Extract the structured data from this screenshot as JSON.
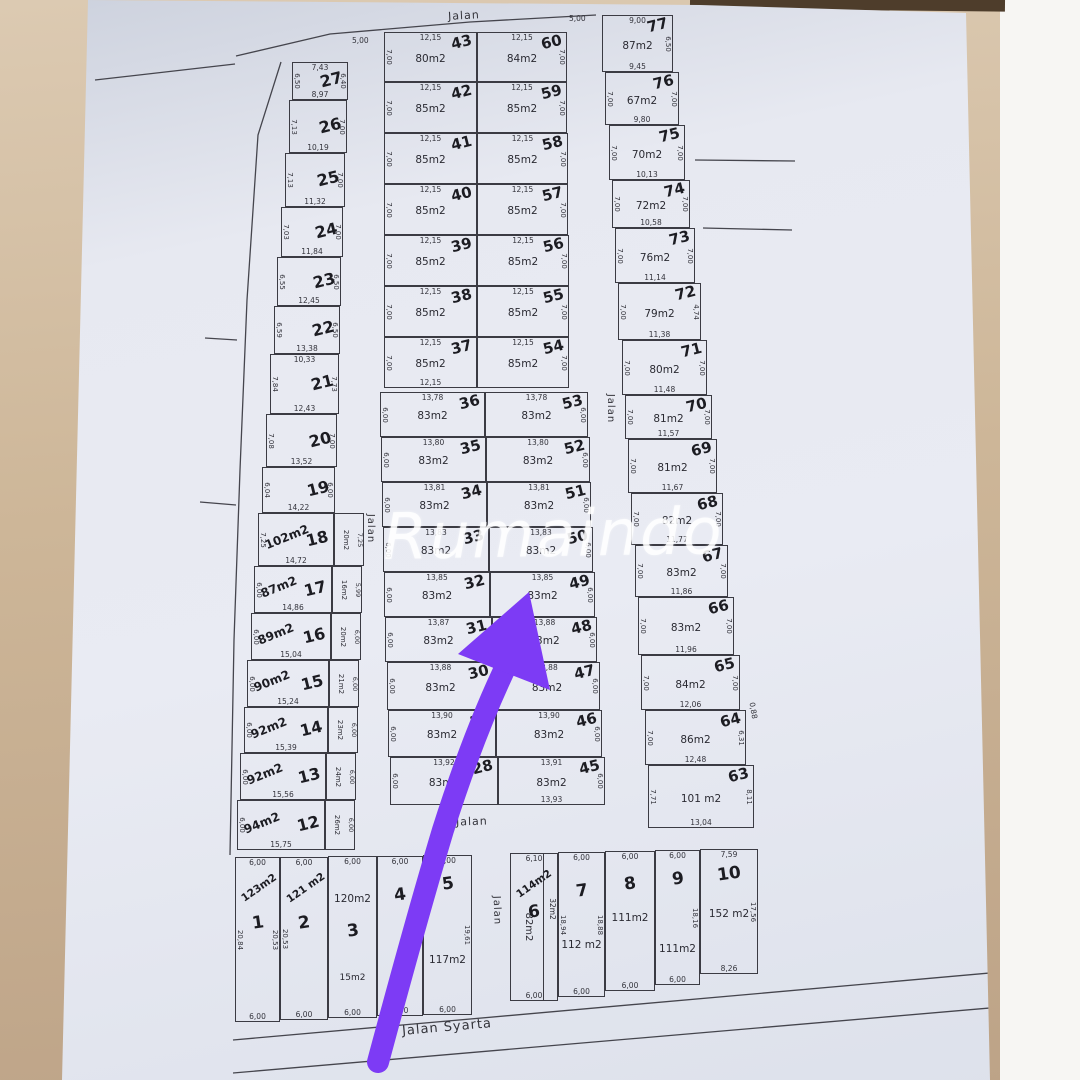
{
  "watermark": "Rumaindo",
  "arrow_color": "#7d3bf5",
  "road_labels": [
    {
      "text": "Jalan",
      "x": 448,
      "y": 9,
      "rot": -3,
      "fs": 11
    },
    {
      "text": "Jalan",
      "x": 356,
      "y": 523,
      "rot": 90,
      "fs": 10
    },
    {
      "text": "Jalan",
      "x": 596,
      "y": 403,
      "rot": 90,
      "fs": 10
    },
    {
      "text": "Jalan",
      "x": 456,
      "y": 815,
      "rot": -2,
      "fs": 11
    },
    {
      "text": "Jalan",
      "x": 482,
      "y": 905,
      "rot": 88,
      "fs": 10
    },
    {
      "text": "Jalan Syarta",
      "x": 402,
      "y": 1020,
      "rot": -5,
      "fs": 13
    }
  ],
  "extra_dims": [
    {
      "text": "5,00",
      "x": 569,
      "y": 14,
      "rot": 0
    },
    {
      "text": "5,00",
      "x": 352,
      "y": 36,
      "rot": 0
    },
    {
      "text": "0,88",
      "x": 745,
      "y": 706,
      "rot": 80
    }
  ],
  "columns": {
    "left": {
      "plots": [
        {
          "num": "27",
          "dimT": "7,43",
          "dimB": "8,97",
          "dimL": "6,50",
          "dimR": "6,40",
          "x": 292,
          "y": 62,
          "w": 56,
          "h": 38
        },
        {
          "num": "26",
          "dimB": "10,19",
          "dimL": "7,13",
          "dimR": "7,00",
          "x": 289,
          "y": 100,
          "w": 58,
          "h": 53
        },
        {
          "num": "25",
          "dimB": "11,32",
          "dimL": "7,13",
          "dimR": "7,00",
          "x": 285,
          "y": 153,
          "w": 60,
          "h": 54
        },
        {
          "num": "24",
          "dimB": "11,84",
          "dimL": "7,03",
          "dimR": "7,00",
          "x": 281,
          "y": 207,
          "w": 62,
          "h": 50
        },
        {
          "num": "23",
          "dimB": "12,45",
          "dimL": "6,55",
          "dimR": "6,50",
          "x": 277,
          "y": 257,
          "w": 64,
          "h": 49
        },
        {
          "num": "22",
          "dimB": "13,38",
          "dimL": "6,59",
          "dimR": "6,50",
          "x": 274,
          "y": 306,
          "w": 66,
          "h": 48
        },
        {
          "num": "21",
          "dimT": "10,33",
          "dimB": "12,43",
          "dimL": "7,84",
          "dimR": "7,73",
          "x": 270,
          "y": 354,
          "w": 69,
          "h": 60
        },
        {
          "num": "20",
          "dimB": "13,52",
          "dimL": "7,08",
          "dimR": "7,00",
          "x": 266,
          "y": 414,
          "w": 71,
          "h": 53
        },
        {
          "num": "19",
          "dimB": "14,22",
          "dimL": "6,04",
          "dimR": "6,00",
          "x": 262,
          "y": 467,
          "w": 73,
          "h": 46
        },
        {
          "num": "18",
          "hand": "102m2",
          "dimB": "14,72",
          "dimL": "7,25",
          "strip": {
            "area": "20m2",
            "dim": "7,25"
          },
          "x": 258,
          "y": 513,
          "w": 76,
          "h": 53
        },
        {
          "num": "17",
          "hand": "87m2",
          "dimB": "14,86",
          "dimL": "6,00",
          "strip": {
            "area": "16m2",
            "dim": "5,99"
          },
          "x": 254,
          "y": 566,
          "w": 78,
          "h": 47
        },
        {
          "num": "16",
          "hand": "89m2",
          "dimB": "15,04",
          "dimL": "6,00",
          "strip": {
            "area": "20m2",
            "dim": "6,00"
          },
          "x": 251,
          "y": 613,
          "w": 80,
          "h": 47
        },
        {
          "num": "15",
          "hand": "90m2",
          "dimB": "15,24",
          "dimL": "6,00",
          "strip": {
            "area": "21m2",
            "dim": "6,00"
          },
          "x": 247,
          "y": 660,
          "w": 82,
          "h": 47
        },
        {
          "num": "14",
          "hand": "92m2",
          "dimB": "15,39",
          "dimL": "6,00",
          "strip": {
            "area": "23m2",
            "dim": "6,00"
          },
          "x": 244,
          "y": 707,
          "w": 84,
          "h": 46
        },
        {
          "num": "13",
          "hand": "92m2",
          "dimB": "15,56",
          "dimL": "6,00",
          "strip": {
            "area": "24m2",
            "dim": "6,00"
          },
          "x": 240,
          "y": 753,
          "w": 86,
          "h": 47
        },
        {
          "num": "12",
          "hand": "94m2",
          "dimB": "15,75",
          "dimL": "6,00",
          "strip": {
            "area": "26m2",
            "dim": "6,00"
          },
          "x": 237,
          "y": 800,
          "w": 88,
          "h": 50
        }
      ]
    },
    "midLeft": {
      "plots": [
        {
          "num": "43",
          "area": "80m2",
          "dimT": "12,15",
          "dimL": "7,00",
          "x": 384,
          "y": 32,
          "w": 93,
          "h": 50
        },
        {
          "num": "42",
          "area": "85m2",
          "dimT": "12,15",
          "dimL": "7,00",
          "x": 384,
          "y": 82,
          "w": 93,
          "h": 51
        },
        {
          "num": "41",
          "area": "85m2",
          "dimT": "12,15",
          "dimL": "7,00",
          "x": 384,
          "y": 133,
          "w": 93,
          "h": 51
        },
        {
          "num": "40",
          "area": "85m2",
          "dimT": "12,15",
          "dimL": "7,00",
          "x": 384,
          "y": 184,
          "w": 93,
          "h": 51
        },
        {
          "num": "39",
          "area": "85m2",
          "dimT": "12,15",
          "dimL": "7,00",
          "x": 384,
          "y": 235,
          "w": 93,
          "h": 51
        },
        {
          "num": "38",
          "area": "85m2",
          "dimT": "12,15",
          "dimL": "7,00",
          "x": 384,
          "y": 286,
          "w": 93,
          "h": 51
        },
        {
          "num": "37",
          "area": "85m2",
          "dimT": "12,15",
          "dimB": "12,15",
          "dimL": "7,00",
          "x": 384,
          "y": 337,
          "w": 93,
          "h": 51
        },
        {
          "num": "36",
          "area": "83m2",
          "dimT": "13,78",
          "dimL": "6,00",
          "x": 380,
          "y": 392,
          "w": 105,
          "h": 45
        },
        {
          "num": "35",
          "area": "83m2",
          "dimT": "13,80",
          "dimL": "6,00",
          "x": 381,
          "y": 437,
          "w": 105,
          "h": 45
        },
        {
          "num": "34",
          "area": "83m2",
          "dimT": "13,81",
          "dimL": "6,00",
          "x": 382,
          "y": 482,
          "w": 105,
          "h": 45
        },
        {
          "num": "33",
          "area": "83m2",
          "dimT": "13,83",
          "dimL": "6,00",
          "x": 383,
          "y": 527,
          "w": 106,
          "h": 45
        },
        {
          "num": "32",
          "area": "83m2",
          "dimT": "13,85",
          "dimL": "6,00",
          "x": 384,
          "y": 572,
          "w": 106,
          "h": 45
        },
        {
          "num": "31",
          "area": "83m2",
          "dimT": "13,87",
          "dimL": "6,00",
          "x": 385,
          "y": 617,
          "w": 107,
          "h": 45
        },
        {
          "num": "30",
          "area": "83m2",
          "dimT": "13,88",
          "dimL": "6,00",
          "x": 387,
          "y": 662,
          "w": 107,
          "h": 48
        },
        {
          "num": "29",
          "area": "83m2",
          "dimT": "13,90",
          "dimL": "6,00",
          "x": 388,
          "y": 710,
          "w": 108,
          "h": 47
        },
        {
          "num": "28",
          "area": "83m2",
          "dimT": "13,92",
          "dimL": "6,00",
          "x": 390,
          "y": 757,
          "w": 108,
          "h": 48
        }
      ]
    },
    "midRight": {
      "plots": [
        {
          "num": "60",
          "area": "84m2",
          "dimT": "12,15",
          "dimR": "7,00",
          "x": 477,
          "y": 32,
          "w": 90,
          "h": 50
        },
        {
          "num": "59",
          "area": "85m2",
          "dimT": "12,15",
          "dimR": "7,00",
          "x": 477,
          "y": 82,
          "w": 90,
          "h": 51
        },
        {
          "num": "58",
          "area": "85m2",
          "dimT": "12,15",
          "dimR": "7,00",
          "x": 477,
          "y": 133,
          "w": 91,
          "h": 51
        },
        {
          "num": "57",
          "area": "85m2",
          "dimT": "12,15",
          "dimR": "7,00",
          "x": 477,
          "y": 184,
          "w": 91,
          "h": 51
        },
        {
          "num": "56",
          "area": "85m2",
          "dimT": "12,15",
          "dimR": "7,00",
          "x": 477,
          "y": 235,
          "w": 92,
          "h": 51
        },
        {
          "num": "55",
          "area": "85m2",
          "dimT": "12,15",
          "dimR": "7,00",
          "x": 477,
          "y": 286,
          "w": 92,
          "h": 51
        },
        {
          "num": "54",
          "area": "85m2",
          "dimT": "12,15",
          "dimR": "7,00",
          "x": 477,
          "y": 337,
          "w": 92,
          "h": 51
        },
        {
          "num": "53",
          "area": "83m2",
          "dimT": "13,78",
          "dimR": "6,00",
          "x": 485,
          "y": 392,
          "w": 103,
          "h": 45
        },
        {
          "num": "52",
          "area": "83m2",
          "dimT": "13,80",
          "dimR": "6,00",
          "x": 486,
          "y": 437,
          "w": 104,
          "h": 45
        },
        {
          "num": "51",
          "area": "83m2",
          "dimT": "13,81",
          "dimR": "6,00",
          "x": 487,
          "y": 482,
          "w": 104,
          "h": 45
        },
        {
          "num": "50",
          "area": "83m2",
          "dimT": "13,83",
          "dimR": "6,00",
          "x": 489,
          "y": 527,
          "w": 104,
          "h": 45
        },
        {
          "num": "49",
          "area": "83m2",
          "dimT": "13,85",
          "dimR": "6,00",
          "x": 490,
          "y": 572,
          "w": 105,
          "h": 45
        },
        {
          "num": "48",
          "area": "83m2",
          "dimT": "13,88",
          "dimR": "6,00",
          "x": 492,
          "y": 617,
          "w": 105,
          "h": 45
        },
        {
          "num": "47",
          "area": "83m2",
          "dimT": "13,88",
          "dimR": "6,00",
          "x": 494,
          "y": 662,
          "w": 106,
          "h": 48
        },
        {
          "num": "46",
          "area": "83m2",
          "dimT": "13,90",
          "dimR": "6,00",
          "x": 496,
          "y": 710,
          "w": 106,
          "h": 47
        },
        {
          "num": "45",
          "area": "83m2",
          "dimT": "13,91",
          "dimB": "13,93",
          "dimR": "6,00",
          "x": 498,
          "y": 757,
          "w": 107,
          "h": 48
        }
      ]
    },
    "right": {
      "plots": [
        {
          "num": "77",
          "area": "87m2",
          "dimT": "9,00",
          "dimB": "9,45",
          "dimR": "6,50",
          "x": 602,
          "y": 15,
          "w": 71,
          "h": 57
        },
        {
          "num": "76",
          "area": "67m2",
          "dimB": "9,80",
          "dimL": "7,00",
          "dimR": "7,00",
          "x": 605,
          "y": 72,
          "w": 74,
          "h": 53
        },
        {
          "num": "75",
          "area": "70m2",
          "dimB": "10,13",
          "dimL": "7,00",
          "dimR": "7,00",
          "x": 609,
          "y": 125,
          "w": 76,
          "h": 55
        },
        {
          "num": "74",
          "area": "72m2",
          "dimB": "10,58",
          "dimL": "7,00",
          "dimR": "7,00",
          "x": 612,
          "y": 180,
          "w": 78,
          "h": 48
        },
        {
          "num": "73",
          "area": "76m2",
          "dimB": "11,14",
          "dimL": "7,00",
          "dimR": "7,00",
          "x": 615,
          "y": 228,
          "w": 80,
          "h": 55
        },
        {
          "num": "72",
          "area": "79m2",
          "dimB": "11,38",
          "dimL": "7,00",
          "dimR": "4,74",
          "x": 618,
          "y": 283,
          "w": 83,
          "h": 57
        },
        {
          "num": "71",
          "area": "80m2",
          "dimB": "11,48",
          "dimL": "7,00",
          "dimR": "7,00",
          "x": 622,
          "y": 340,
          "w": 85,
          "h": 55
        },
        {
          "num": "70",
          "area": "81m2",
          "dimB": "11,57",
          "dimL": "7,00",
          "dimR": "7,00",
          "x": 625,
          "y": 395,
          "w": 87,
          "h": 44
        },
        {
          "num": "69",
          "area": "81m2",
          "dimB": "11,67",
          "dimL": "7,00",
          "dimR": "7,00",
          "x": 628,
          "y": 439,
          "w": 89,
          "h": 54
        },
        {
          "num": "68",
          "area": "82m2",
          "dimB": "11,77",
          "dimL": "7,00",
          "dimR": "7,00",
          "x": 631,
          "y": 493,
          "w": 92,
          "h": 52
        },
        {
          "num": "67",
          "area": "83m2",
          "dimB": "11,86",
          "dimL": "7,00",
          "dimR": "7,00",
          "x": 635,
          "y": 545,
          "w": 93,
          "h": 52
        },
        {
          "num": "66",
          "area": "83m2",
          "dimB": "11,96",
          "dimL": "7,00",
          "dimR": "7,00",
          "x": 638,
          "y": 597,
          "w": 96,
          "h": 58
        },
        {
          "num": "65",
          "area": "84m2",
          "dimB": "12,06",
          "dimL": "7,00",
          "dimR": "7,00",
          "x": 641,
          "y": 655,
          "w": 99,
          "h": 55
        },
        {
          "num": "64",
          "area": "86m2",
          "dimB": "12,48",
          "dimL": "7,00",
          "dimR": "6,31",
          "x": 645,
          "y": 710,
          "w": 101,
          "h": 55
        },
        {
          "num": "63",
          "area": "101 m2",
          "dimB": "13,04",
          "dimL": "7,71",
          "dimR": "8,11",
          "x": 648,
          "y": 765,
          "w": 106,
          "h": 63
        }
      ]
    },
    "bottom": {
      "plots": [
        {
          "num": "1",
          "hand": "123m2",
          "dimT": "6,00",
          "dimB": "6,00",
          "dimL": "20,84",
          "dimR": "20,53",
          "numTop": "55px",
          "x": 235,
          "y": 857,
          "w": 45,
          "h": 165
        },
        {
          "num": "2",
          "hand": "121 m2",
          "dimT": "6,00",
          "dimB": "6,00",
          "dimL": "20,53",
          "numTop": "55px",
          "x": 280,
          "y": 857,
          "w": 48,
          "h": 163
        },
        {
          "num": "3",
          "area": "120m2",
          "areaTop": "36px",
          "note": "15m2",
          "dimT": "6,00",
          "dimB": "6,00",
          "numTop": "64px",
          "x": 328,
          "y": 856,
          "w": 49,
          "h": 162
        },
        {
          "num": "4",
          "dimT": "6,00",
          "dimB": "6,00",
          "numTop": "28px",
          "x": 377,
          "y": 856,
          "w": 46,
          "h": 160
        },
        {
          "num": "5",
          "area": "117m2",
          "areaTop": "98px",
          "dimT": "6,00",
          "dimB": "6,00",
          "dimR": "19,61",
          "numTop": "18px",
          "x": 423,
          "y": 855,
          "w": 49,
          "h": 160
        },
        {
          "num": "6",
          "area": "82m2",
          "areaRot": true,
          "hand": "114m2",
          "note2": "32m2",
          "vline": 13,
          "dimT": "6,10",
          "dimB": "6,00",
          "numTop": "48px",
          "x": 510,
          "y": 853,
          "w": 48,
          "h": 148
        },
        {
          "num": "7",
          "area": "112 m2",
          "areaTop": "86px",
          "dimT": "6,00",
          "dimB": "6,00",
          "dimL": "18,94",
          "dimR": "18,88",
          "numTop": "28px",
          "x": 558,
          "y": 852,
          "w": 47,
          "h": 145
        },
        {
          "num": "8",
          "area": "111m2",
          "areaTop": "60px",
          "dimT": "6,00",
          "dimB": "6,00",
          "numTop": "22px",
          "x": 605,
          "y": 851,
          "w": 50,
          "h": 140
        },
        {
          "num": "9",
          "area": "111m2",
          "areaTop": "92px",
          "dimT": "6,00",
          "dimB": "6,00",
          "dimR": "18,16",
          "numTop": "18px",
          "x": 655,
          "y": 850,
          "w": 45,
          "h": 135
        },
        {
          "num": "10",
          "area": "152 m2",
          "areaTop": "58px",
          "dimT": "7,59",
          "dimB": "8,26",
          "dimR": "17,56",
          "numTop": "14px",
          "x": 700,
          "y": 849,
          "w": 58,
          "h": 125
        }
      ]
    }
  }
}
